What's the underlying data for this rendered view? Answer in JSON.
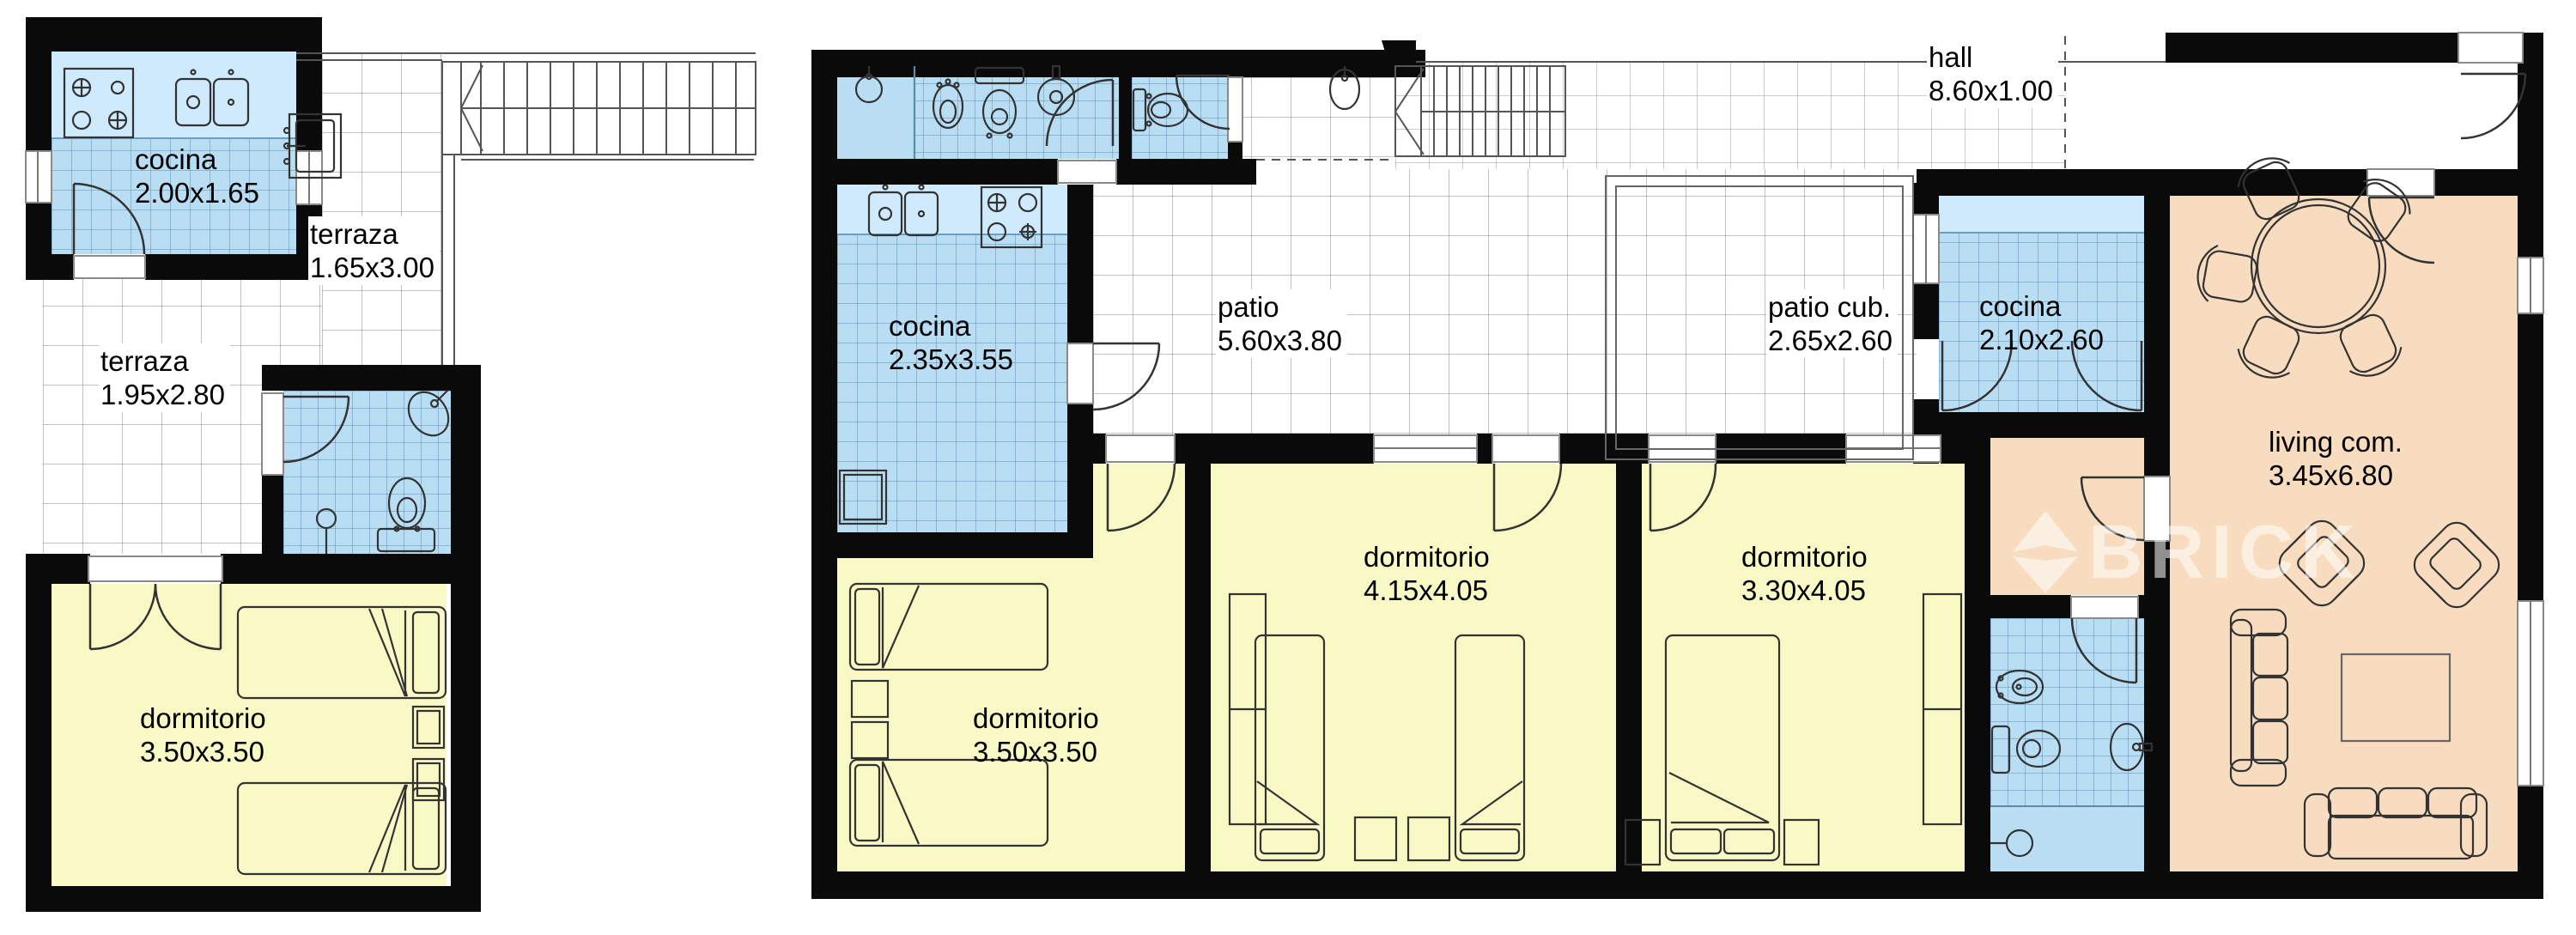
{
  "watermark": {
    "text": "BRICK",
    "logo": "diamond-icon"
  },
  "colors": {
    "wall": "#0a0a0a",
    "wet_room": "#b9def4",
    "bedroom": "#f9f9c5",
    "living": "#f8dcc0",
    "tile_line": "#6d9cbd"
  },
  "plans": [
    {
      "id": "planta-alta",
      "rooms": [
        {
          "name": "cocina",
          "dims": "2.00x1.65"
        },
        {
          "name": "terraza",
          "dims": "1.65x3.00"
        },
        {
          "name": "terraza",
          "dims": "1.95x2.80"
        },
        {
          "name": "dormitorio",
          "dims": "3.50x3.50"
        }
      ]
    },
    {
      "id": "planta-baja",
      "rooms": [
        {
          "name": "cocina",
          "dims": "2.35x3.55"
        },
        {
          "name": "patio",
          "dims": "5.60x3.80"
        },
        {
          "name": "hall",
          "dims": "8.60x1.00"
        },
        {
          "name": "patio cub.",
          "dims": "2.65x2.60"
        },
        {
          "name": "cocina",
          "dims": "2.10x2.60"
        },
        {
          "name": "living com.",
          "dims": "3.45x6.80"
        },
        {
          "name": "dormitorio",
          "dims": "3.50x3.50"
        },
        {
          "name": "dormitorio",
          "dims": "4.15x4.05"
        },
        {
          "name": "dormitorio",
          "dims": "3.30x4.05"
        }
      ]
    }
  ]
}
